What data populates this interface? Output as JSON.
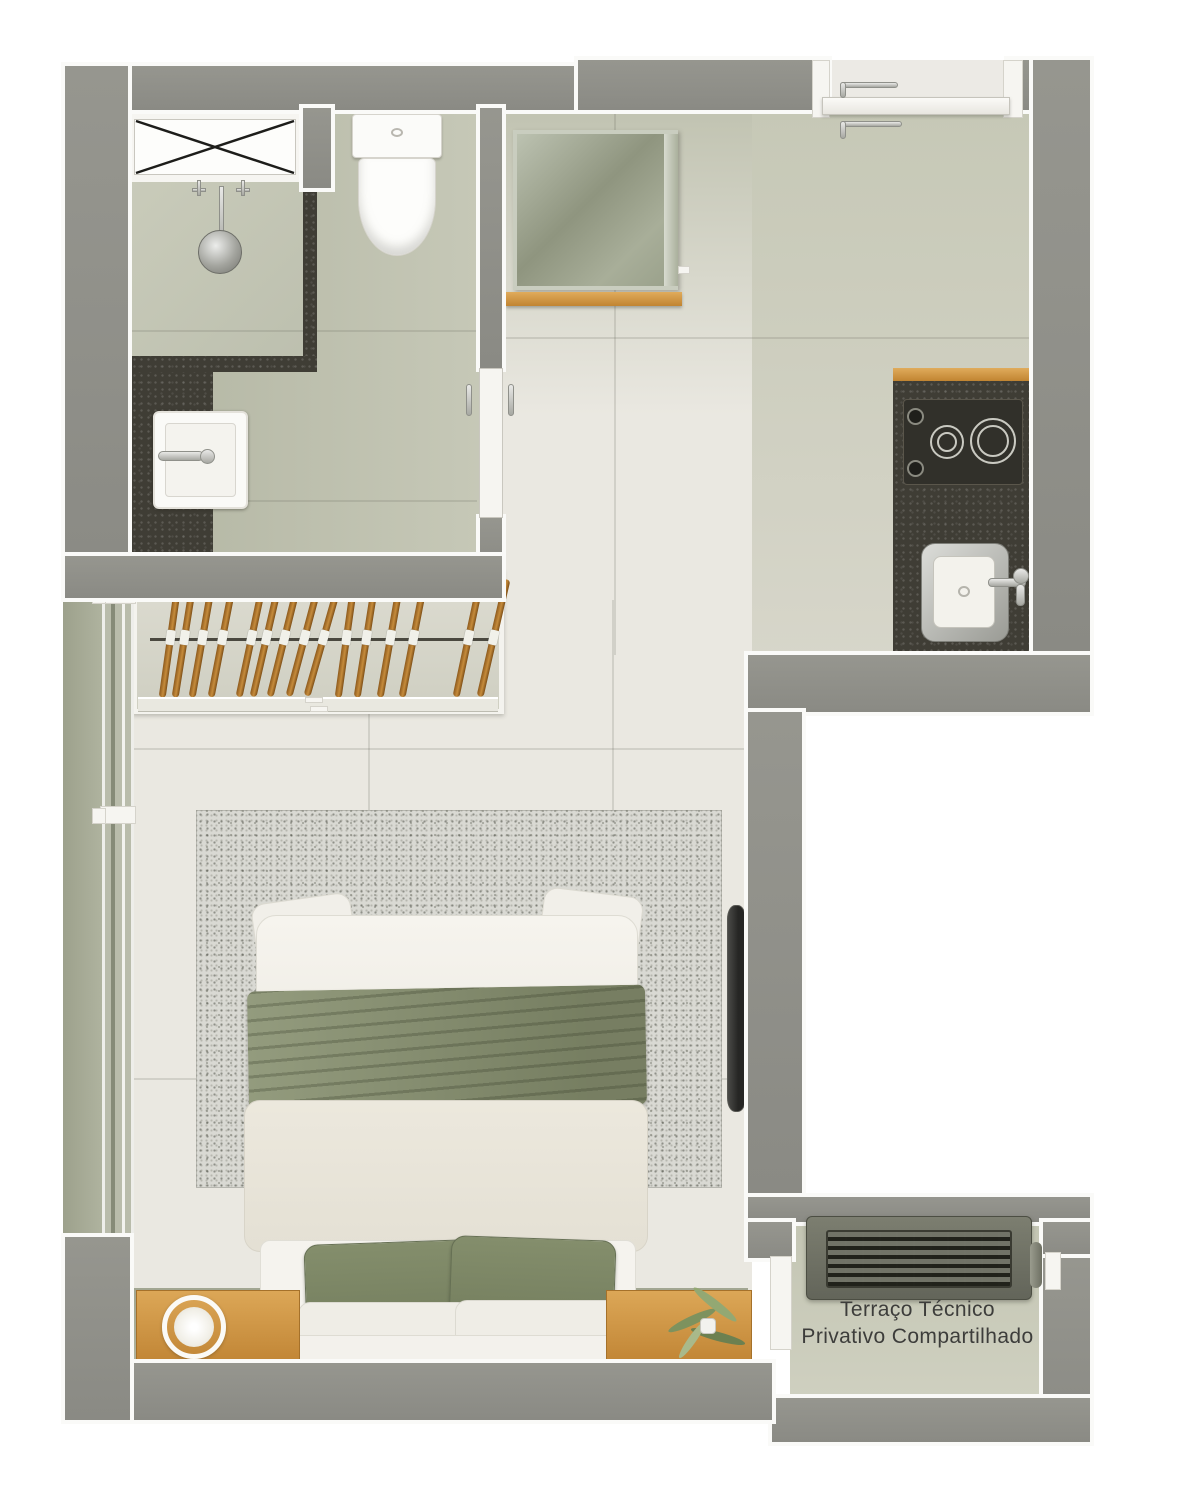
{
  "terrace": {
    "label_line1": "Terraço Técnico",
    "label_line2": "Privativo Compartilhado"
  },
  "closet": {
    "hanger_count": 15,
    "hanger_offsets": [
      35,
      49,
      67,
      87,
      116,
      131,
      149,
      169,
      188,
      211,
      231,
      255,
      278,
      333,
      358
    ]
  },
  "kitchen": {
    "burner_count": 2,
    "knob_count": 2
  },
  "colors": {
    "wall_gray": "#8e8e88",
    "floor_bathroom_sage": "#b7baa8",
    "floor_kitchen_sage": "#cdcfbe",
    "floor_bedroom_light": "#eae8e1",
    "floor_terrace_sage": "#c8cab9",
    "counter_charcoal": "#3f3d35",
    "wood_accent": "#d29b4a",
    "textile_green": "#87906f",
    "pillow_green": "#7d8767",
    "rug_speckle": "#d9d9d3",
    "label_text": "#3d3d3b"
  },
  "fixtures": [
    "duct-shaft",
    "shower",
    "vanity-sink",
    "toilet",
    "mirror-cabinet",
    "entry-door",
    "cooktop",
    "kitchen-sink",
    "clothes-rail",
    "sliding-window",
    "double-bed",
    "nightstand-lamp",
    "nightstand-plant",
    "tv-panel",
    "ac-condenser"
  ]
}
